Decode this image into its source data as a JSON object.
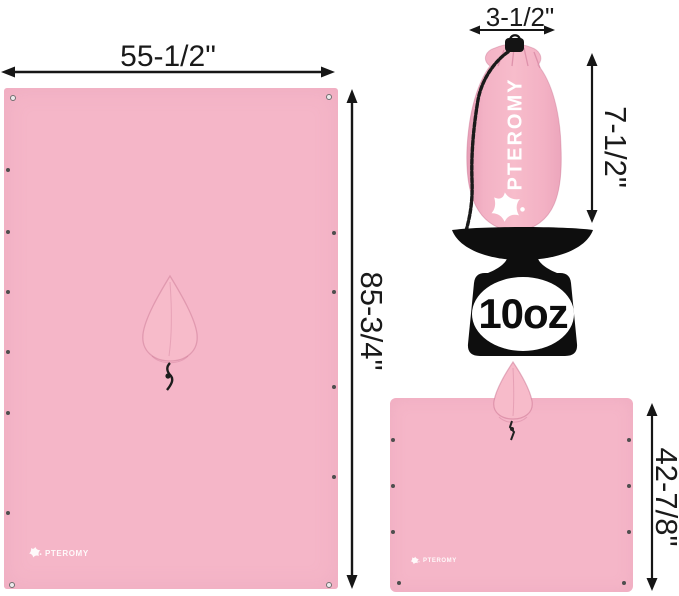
{
  "brand": "PTEROMY",
  "colors": {
    "fabric_pink": "#f5b6c8",
    "fabric_pink_light": "#f7bbca",
    "fabric_pink_shade": "#e79fb7",
    "ink_black": "#161616",
    "scale_black": "#0e0e0e",
    "logo_white": "#ffffff"
  },
  "icons": {
    "mascot": "pteromy-mascot-icon (flying-squirrel star)",
    "scale": "weight-scale-icon",
    "grommet": "grommet-eyelet-dot",
    "drawstring": "drawstring-cord",
    "arrows": "double-headed-dimension-arrow"
  },
  "flat_tarp": {
    "width_label": "55-1/2\"",
    "height_label": "85-3/4\"",
    "logo_text": "PTEROMY"
  },
  "stuff_sack": {
    "width_label": "3-1/2\"",
    "height_label": "7-1/2\"",
    "brand_text": "PTEROMY"
  },
  "weight_scale": {
    "weight_label": "10oz"
  },
  "poncho": {
    "height_label": "42-7/8\"",
    "logo_text": "PTEROMY"
  }
}
